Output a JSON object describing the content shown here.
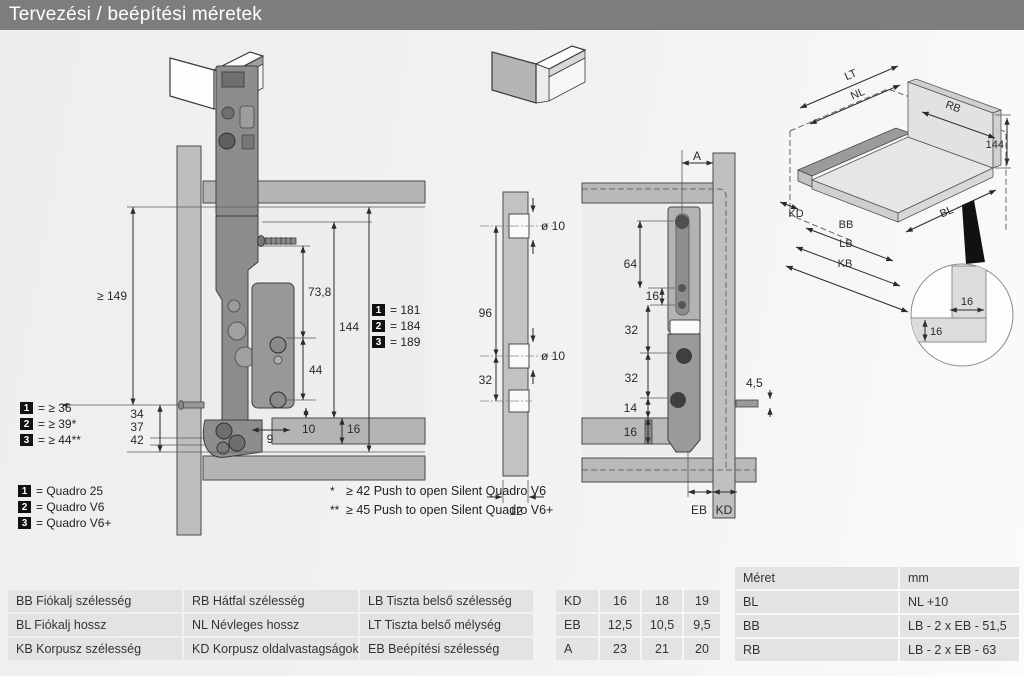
{
  "title": "Tervezési / beépítési méretek",
  "colors": {
    "title_bar": "#7d7d7d",
    "table_cell": "#e3e3e3",
    "panel_gray": "#bdbdbd",
    "slide_gray": "#8d8d8d"
  },
  "legend": {
    "items": [
      {
        "num": "1",
        "label": "= Quadro 25"
      },
      {
        "num": "2",
        "label": "= Quadro V6"
      },
      {
        "num": "3",
        "label": "= Quadro V6+"
      }
    ]
  },
  "footnotes": [
    {
      "mark": "*",
      "text": "≥ 42 Push to open Silent Quadro V6"
    },
    {
      "mark": "**",
      "text": "≥ 45 Push to open Silent Quadro V6+"
    }
  ],
  "side_view": {
    "depth_min": "≥ 149",
    "front_gap_values": [
      "34",
      "37",
      "42"
    ],
    "front_key": [
      {
        "num": "1",
        "label": "= ≥ 36"
      },
      {
        "num": "2",
        "label": "= ≥ 39*"
      },
      {
        "num": "3",
        "label": "= ≥ 44**"
      }
    ],
    "screw_height": "73,8",
    "side_height": "144",
    "hole_span": "44",
    "dim9": "9",
    "dim10": "10",
    "bottom_thickness": "16",
    "height_key": [
      {
        "num": "1",
        "label": "= 181"
      },
      {
        "num": "2",
        "label": "= 184"
      },
      {
        "num": "3",
        "label": "= 189"
      }
    ]
  },
  "bore_view": {
    "hole_dia_top": "ø 10",
    "hole_dia_mid": "ø 10",
    "spacing_96": "96",
    "spacing_32": "32",
    "panel_thickness": "12"
  },
  "rear_view": {
    "dim_a": "A",
    "dim64": "64",
    "dim16": "16",
    "dim32a": "32",
    "dim32b": "32",
    "dim14": "14",
    "dim16b": "16",
    "dim45": "4,5",
    "eb": "EB",
    "kd": "KD"
  },
  "iso_view": {
    "lt": "LT",
    "nl": "NL",
    "rb": "RB",
    "h144": "144",
    "kd": "KD",
    "bb": "BB",
    "lb": "LB",
    "kb": "KB",
    "bl": "BL",
    "detail16a": "16",
    "detail16b": "16"
  },
  "tables": {
    "abbrev": {
      "cells": [
        "BB Fiókalj szélesség",
        "RB Hátfal szélesség",
        "LB Tiszta belső szélesség",
        "BL Fiókalj hossz",
        "NL Névleges hossz",
        "LT Tiszta belső mélység",
        "KB Korpusz szélesség",
        "KD Korpusz oldalvastagságok",
        "EB Beépítési szélesség"
      ]
    },
    "values": {
      "rows": [
        [
          "KD",
          "16",
          "18",
          "19"
        ],
        [
          "EB",
          "12,5",
          "10,5",
          "9,5"
        ],
        [
          "A",
          "23",
          "21",
          "20"
        ]
      ]
    },
    "formulas": {
      "header": [
        "Méret",
        "mm"
      ],
      "rows": [
        [
          "BL",
          "NL +10"
        ],
        [
          "BB",
          "LB - 2 x EB - 51,5"
        ],
        [
          "RB",
          "LB - 2 x EB - 63"
        ]
      ]
    }
  }
}
